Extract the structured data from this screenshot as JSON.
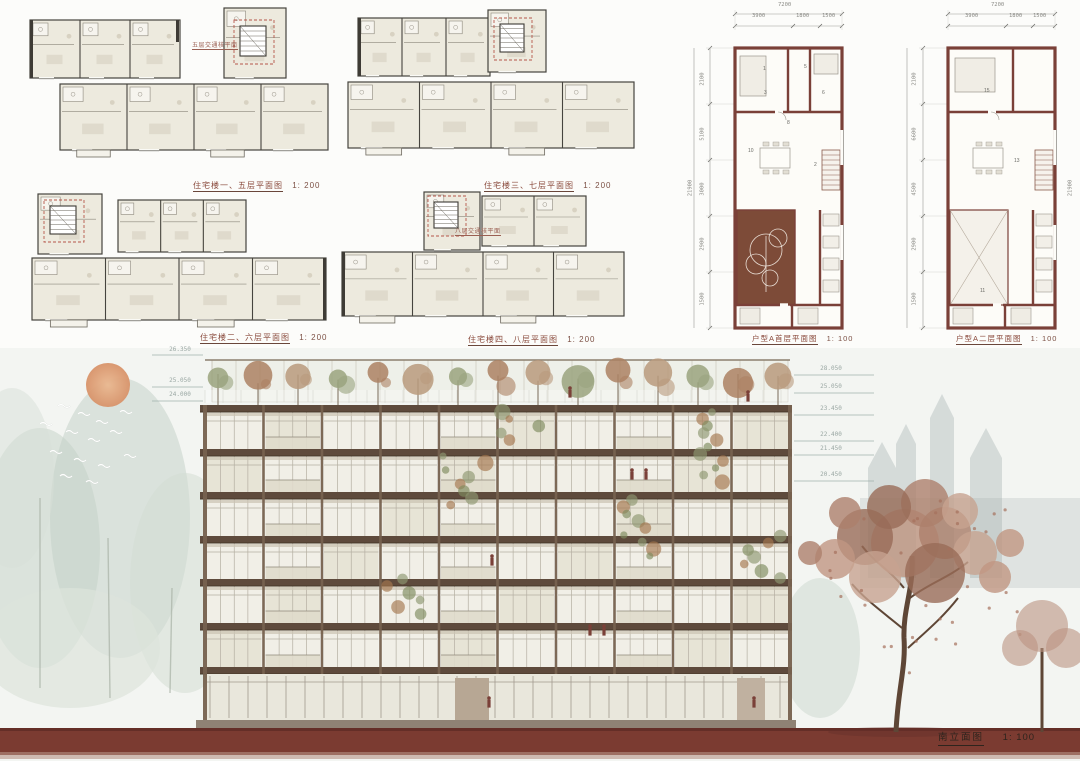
{
  "board_title": "residential-building-presentation",
  "floor_plans": {
    "plan1": {
      "caption": "住宅楼一、五层平面图",
      "scale": "1: 200",
      "core_note": "五层交通核平面"
    },
    "plan2": {
      "caption": "住宅楼三、七层平面图",
      "scale": "1: 200"
    },
    "plan3": {
      "caption": "住宅楼二、六层平面图",
      "scale": "1: 200"
    },
    "plan4": {
      "caption": "住宅楼四、八层平面图",
      "scale": "1: 200",
      "core_note": "八层交通核平面"
    }
  },
  "unit_plans": {
    "plan_a_ground": {
      "caption": "户型A首层平面图",
      "scale": "1: 100",
      "dim_total_top": "7200",
      "dims_top": [
        "3900",
        "1800",
        "1500"
      ],
      "dims_left": [
        "2100",
        "5100",
        "3000",
        "2900",
        "1500"
      ],
      "dim_total_side": "21900",
      "room_numbers": [
        "1",
        "5",
        "3",
        "6",
        "8",
        "10",
        "2"
      ]
    },
    "plan_a_second": {
      "caption": "户型A二层平面图",
      "scale": "1: 100",
      "dim_total_top": "7200",
      "dims_top": [
        "3900",
        "1800",
        "1500"
      ],
      "dims_left": [
        "2100",
        "6600",
        "4500",
        "2900",
        "1500"
      ],
      "dim_total_side": "21900",
      "room_numbers": [
        "15",
        "13",
        "11"
      ]
    }
  },
  "elevation": {
    "caption": "南立面图",
    "scale": "1: 100",
    "levels_right": [
      "28.050",
      "25.050",
      "23.450",
      "22.400",
      "21.450",
      "20.450"
    ],
    "levels_left": [
      "26.350",
      "25.050",
      "24.000"
    ]
  },
  "colors": {
    "ground_maroon": "#7b3b31",
    "unit_wall": "#7a4038",
    "slab_brown": "#5e4a3c",
    "plan_fill": "#edeade",
    "sun": "#dd9c6f"
  }
}
